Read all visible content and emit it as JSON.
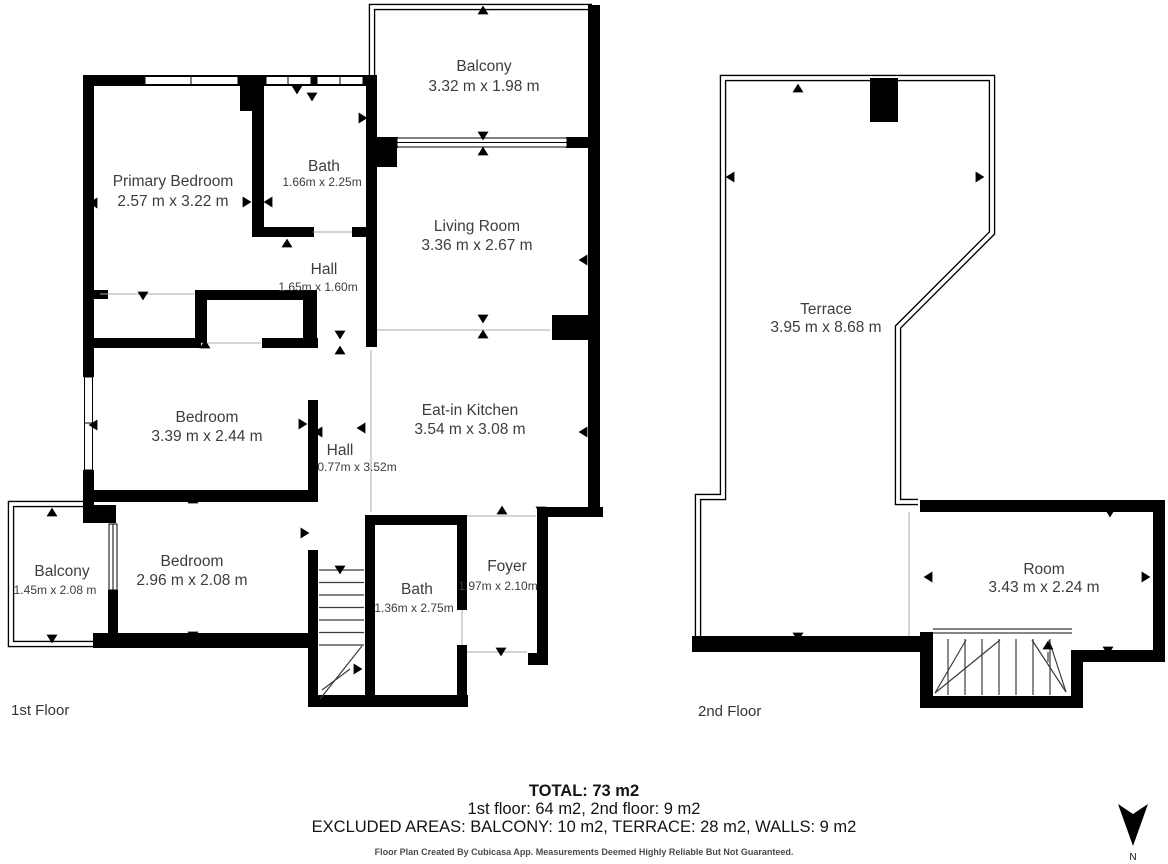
{
  "floors": [
    {
      "label": "1st Floor",
      "rooms": [
        {
          "name": "Balcony",
          "dims": "3.32 m x 1.98 m"
        },
        {
          "name": "Primary Bedroom",
          "dims": "2.57 m x 3.22 m"
        },
        {
          "name": "Bath",
          "dims": "1.66m x 2.25m"
        },
        {
          "name": "Hall",
          "dims": "1.65m x 1.60m"
        },
        {
          "name": "Living Room",
          "dims": "3.36 m x 2.67 m"
        },
        {
          "name": "Bedroom",
          "dims": "3.39 m x 2.44 m"
        },
        {
          "name": "Hall",
          "dims": "0.77m x 3.52m"
        },
        {
          "name": "Eat-in Kitchen",
          "dims": "3.54 m x 3.08 m"
        },
        {
          "name": "Balcony",
          "dims": "1.45m x 2.08 m"
        },
        {
          "name": "Bedroom",
          "dims": "2.96 m x 2.08 m"
        },
        {
          "name": "Bath",
          "dims": "1.36m x 2.75m"
        },
        {
          "name": "Foyer",
          "dims": "1.97m x 2.10m"
        }
      ]
    },
    {
      "label": "2nd Floor",
      "rooms": [
        {
          "name": "Terrace",
          "dims": "3.95 m x 8.68 m"
        },
        {
          "name": "Room",
          "dims": "3.43 m x 2.24 m"
        }
      ]
    }
  ],
  "summary": {
    "total": "TOTAL: 73 m2",
    "floors_line": "1st floor: 64 m2, 2nd floor: 9 m2",
    "excluded_line": "EXCLUDED AREAS: BALCONY: 10 m2, TERRACE: 28 m2, WALLS: 9 m2"
  },
  "disclaimer": "Floor Plan Created By Cubicasa App. Measurements Deemed Highly Reliable But Not Guaranteed.",
  "compass": {
    "label": "N"
  },
  "colors": {
    "wall": "#000000",
    "room_text": "#3d3d3d",
    "summary_text": "#141414",
    "thin_line": "#a8a8a8"
  }
}
